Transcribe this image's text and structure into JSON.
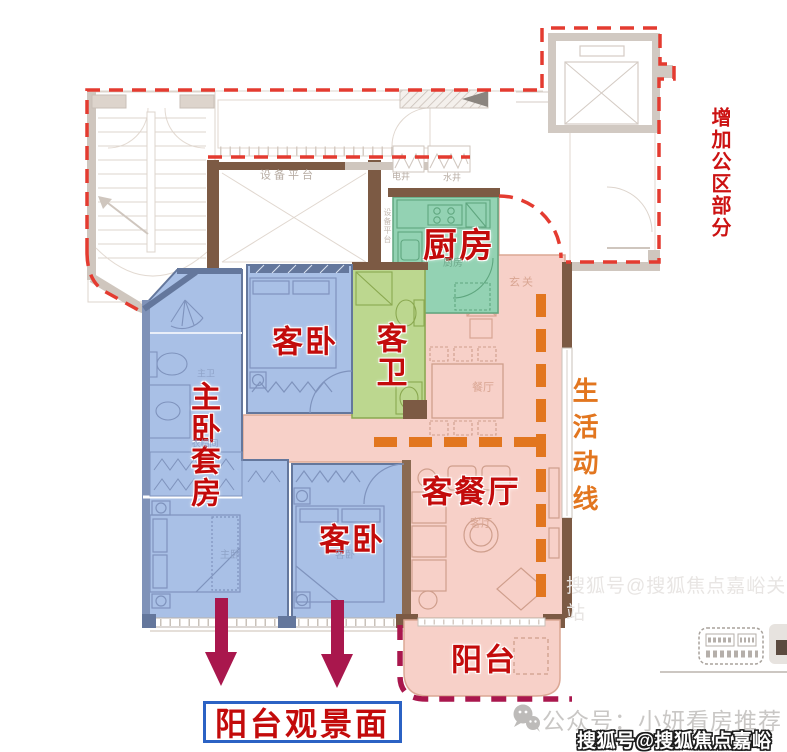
{
  "annotations": {
    "added_public_area": "增加公区部分",
    "life_line": "生活动线",
    "balcony_view_label": "阳台观景面"
  },
  "rooms": {
    "kitchen": "厨房",
    "guest_bathroom": "客卫",
    "guest_bedroom_upper": "客卧",
    "master_suite": "主卧套房",
    "living_dining": "客餐厅",
    "guest_bedroom_lower": "客卧",
    "balcony": "阳台"
  },
  "plan_labels": {
    "equipment_platform": "设备平台",
    "equipment_platform_side": "设备平台",
    "electric_shaft": "电井",
    "water_shaft": "水井",
    "entry": "玄关",
    "kitchen_small": "厨房",
    "dining_small": "餐厅",
    "living_small": "客厅",
    "master_bath_small": "主卫",
    "closet_small": "衣帽间",
    "master_bed_small": "主卧",
    "guest_bed_small": "客卧"
  },
  "watermarks": {
    "wechat_account": "公众号：小妍看房推荐",
    "sohu_account": "搜狐号@搜狐焦点嘉峪关站",
    "sohu_account_faint": "搜狐号@搜狐焦点嘉峪关站"
  },
  "icons": {
    "wechat": "wechat-bubbles-icon",
    "footer_stamp": "dashed-stamp-icon"
  },
  "colors": {
    "room_blue": "#a9c0e6",
    "kitchen_green": "#93d2b3",
    "bath_green": "#bcd78f",
    "area_pink": "#f7d0c8",
    "boundary_red": "#e43b30",
    "label_red": "#c30b0b",
    "flow_orange": "#e2761f",
    "arrow_crimson": "#a9174d",
    "view_box_blue": "#2b62c4"
  }
}
